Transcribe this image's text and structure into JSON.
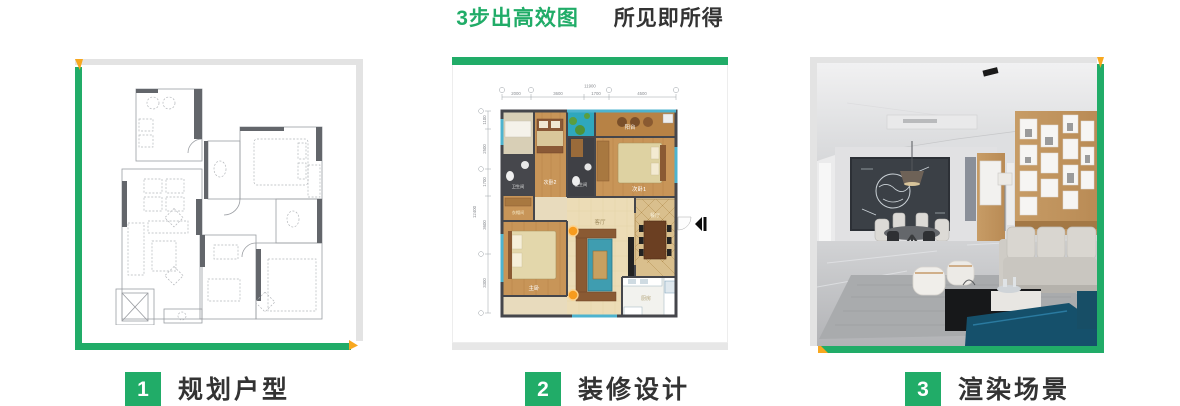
{
  "title": {
    "highlight": "3步出高效图",
    "rest": "所见即所得"
  },
  "steps": [
    {
      "number": "1",
      "label": "规划户型"
    },
    {
      "number": "2",
      "label": "装修设计"
    },
    {
      "number": "3",
      "label": "渲染场景"
    }
  ],
  "colored_plan": {
    "rooms": {
      "balcony": "阳台",
      "bedroom1": "次卧1",
      "bedroom2": "次卧2",
      "bathroom": "卫生间",
      "cloakroom": "衣帽间",
      "master_bedroom": "主卧",
      "living_room": "客厅",
      "dining_room": "餐厅",
      "kitchen": "厨房"
    },
    "dimensions": {
      "top_total": "11900",
      "top": [
        "2000",
        "3600",
        "1700",
        "4500"
      ],
      "left_total": "12400",
      "left": [
        "1100",
        "2500",
        "1700",
        "3600",
        "3300"
      ]
    }
  },
  "colors": {
    "green": "#21ac68",
    "orange": "#f8a81f",
    "text_dark": "#333333",
    "border_gray": "#e3e3e3"
  }
}
